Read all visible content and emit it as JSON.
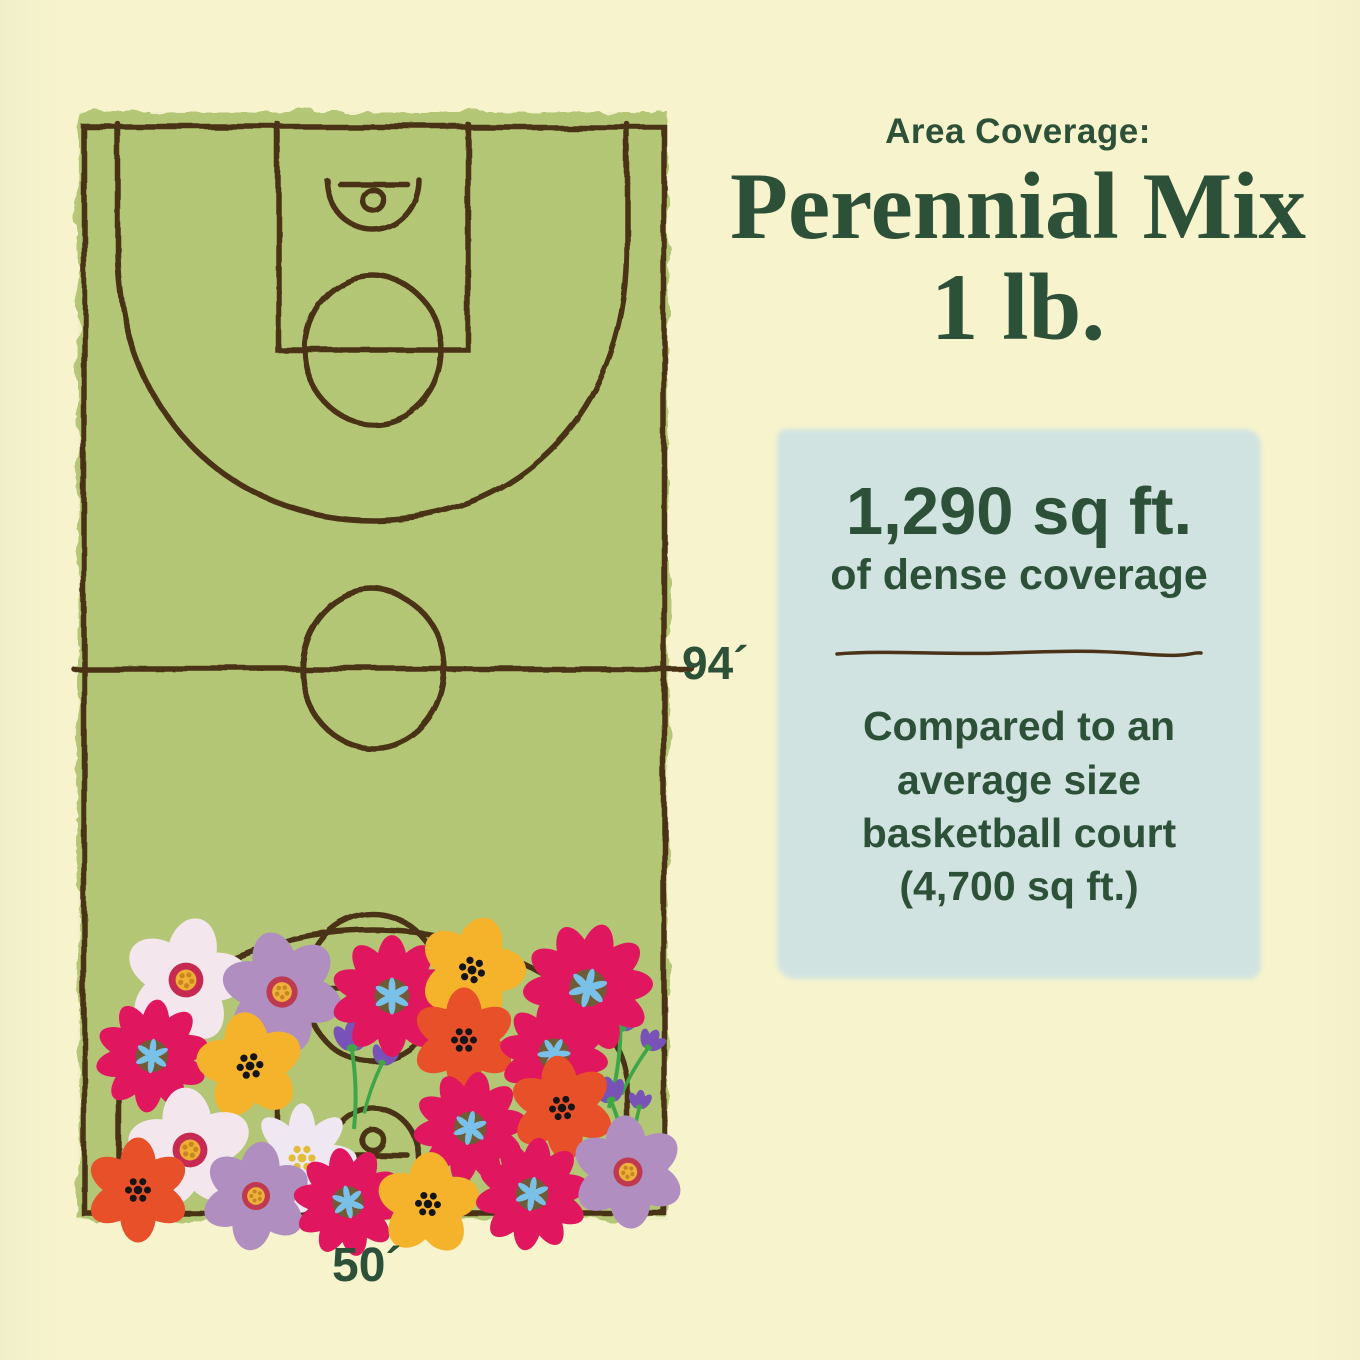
{
  "theme": {
    "page_bg": "#f7f4cd",
    "text_green": "#2d5138",
    "card_bg": "#d1e3e1",
    "court_fill": "#b5c877",
    "line_brown": "#4a3318"
  },
  "header": {
    "eyebrow": "Area Coverage:",
    "title_line1": "Perennial Mix",
    "title_line2": "1 lb."
  },
  "coverage_card": {
    "headline": "1,290 sq ft.",
    "subhead": "of dense coverage",
    "comparison_lines": [
      "Compared to an",
      "average size",
      "basketball court",
      "(4,700 sq ft.)"
    ]
  },
  "court": {
    "length_label": "94´",
    "width_label": "50´"
  },
  "illustration": {
    "palette": {
      "magenta": "#e0175e",
      "magenta_center": "#6f5b36",
      "magenta_star": "#79c1e8",
      "golden": "#f5b32c",
      "black_dot": "#151515",
      "orangered": "#e8502a",
      "white5": "#f3e7ed",
      "white5_ring": "#c62a52",
      "white5_core": "#efae35",
      "white5_dots": "#c8861f",
      "mauve": "#b08fc0",
      "mauve_ring": "#bf3a50",
      "mauve_core": "#eeb13c",
      "whitedaisy": "#efe8f3",
      "daisy_core": "#e2bd39",
      "bell": "#7852b6",
      "stem": "#3fa648"
    },
    "flowers": [
      {
        "type": "bells",
        "x": 352,
        "y": 1042,
        "r": 30,
        "rot": 0
      },
      {
        "type": "bells",
        "x": 622,
        "y": 1022,
        "r": 30,
        "rot": 10
      },
      {
        "type": "bells",
        "x": 610,
        "y": 1095,
        "r": 26,
        "rot": -12
      },
      {
        "type": "white5",
        "x": 186,
        "y": 980,
        "r": 58,
        "rot": 12
      },
      {
        "type": "mauve",
        "x": 282,
        "y": 992,
        "r": 58,
        "rot": -14
      },
      {
        "type": "magenta",
        "x": 392,
        "y": 996,
        "r": 58,
        "rot": 0
      },
      {
        "type": "golden",
        "x": 472,
        "y": 970,
        "r": 52,
        "rot": 18
      },
      {
        "type": "magenta",
        "x": 588,
        "y": 988,
        "r": 62,
        "rot": 14
      },
      {
        "type": "magenta",
        "x": 152,
        "y": 1056,
        "r": 54,
        "rot": 6
      },
      {
        "type": "golden",
        "x": 250,
        "y": 1066,
        "r": 52,
        "rot": -8
      },
      {
        "type": "orangered",
        "x": 464,
        "y": 1040,
        "r": 50,
        "rot": 0
      },
      {
        "type": "magenta",
        "x": 554,
        "y": 1054,
        "r": 52,
        "rot": 28
      },
      {
        "type": "white5",
        "x": 190,
        "y": 1150,
        "r": 58,
        "rot": -6
      },
      {
        "type": "whitedaisy",
        "x": 302,
        "y": 1158,
        "r": 52,
        "rot": 0
      },
      {
        "type": "magenta",
        "x": 470,
        "y": 1128,
        "r": 54,
        "rot": 10
      },
      {
        "type": "orangered",
        "x": 562,
        "y": 1108,
        "r": 50,
        "rot": -6
      },
      {
        "type": "orangered",
        "x": 138,
        "y": 1190,
        "r": 50,
        "rot": 0
      },
      {
        "type": "mauve",
        "x": 256,
        "y": 1196,
        "r": 52,
        "rot": 8
      },
      {
        "type": "magenta",
        "x": 348,
        "y": 1202,
        "r": 52,
        "rot": -10
      },
      {
        "type": "golden",
        "x": 428,
        "y": 1204,
        "r": 50,
        "rot": 4
      },
      {
        "type": "magenta",
        "x": 532,
        "y": 1194,
        "r": 54,
        "rot": 8
      },
      {
        "type": "mauve",
        "x": 628,
        "y": 1172,
        "r": 54,
        "rot": -4
      }
    ]
  }
}
